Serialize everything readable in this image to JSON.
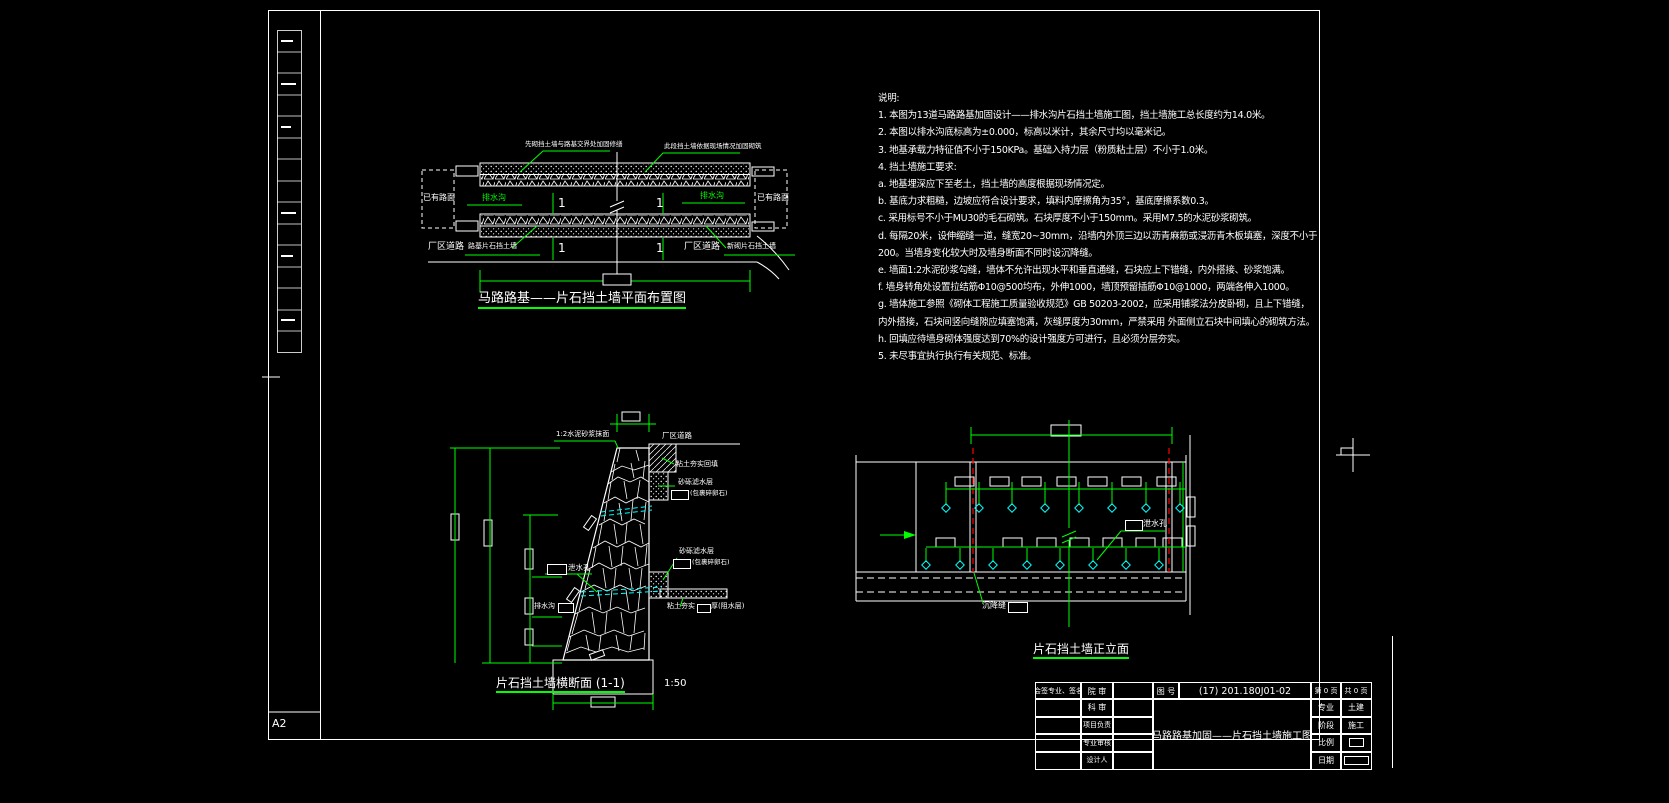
{
  "frame": {
    "size_label": "A2"
  },
  "plan": {
    "title": "马路路基——片石挡土墙平面布置图",
    "existing_left": "已有路面",
    "existing_right": "已有路面",
    "drain_left": "排水沟",
    "drain_right": "排水沟",
    "road_left": "厂区道路",
    "road_right": "厂区道路",
    "leader_top_left": "先砌挡土墙与路基交界处加固修缮",
    "leader_top_right": "此段挡土墙依据现场情况加固砌筑",
    "leader_bottom_left": "路基片石挡土墙",
    "leader_bottom_right": "新砌片石挡土墙",
    "section_mark": "1"
  },
  "notes": {
    "heading": "说明:",
    "lines": [
      "1. 本图为13道马路路基加固设计——排水沟片石挡土墙施工图，挡土墙施工总长度约为14.0米。",
      "2. 本图以排水沟底标高为±0.000，标高以米计，其余尺寸均以毫米记。",
      "3. 地基承载力特征值不小于150KPa。基础入持力层（粉质粘土层）不小于1.0米。",
      "4. 挡土墙施工要求:",
      "a. 地基埋深应下至老土，挡土墙的高度根据现场情况定。",
      "b. 基底力求粗糙，边坡应符合设计要求，填料内摩擦角为35°，基底摩擦系数0.3。",
      "c. 采用标号不小于MU30的毛石砌筑。石块厚度不小于150mm。采用M7.5的水泥砂浆砌筑。",
      "d. 每隔20米，设伸缩缝一道，缝宽20~30mm，沿墙内外顶三边以沥青麻筋或浸沥青木板填塞，深度不小于",
      "200。当墙身变化较大时及墙身断面不同时设沉降缝。",
      "e. 墙面1:2水泥砂浆勾缝，墙体不允许出现水平和垂直通缝，石块应上下错缝，内外搭接、砂浆饱满。",
      "f. 墙身转角处设置拉结筋Φ10@500均布，外伸1000，墙顶预留插筋Φ10@1000，两端各伸入1000。",
      "g. 墙体施工参照《砌体工程施工质量验收规范》GB 50203-2002，应采用铺浆法分皮卧砌，且上下错缝，",
      "内外搭接，石块间竖向缝隙应填塞饱满，灰缝厚度为30mm，严禁采用 外面侧立石块中间填心的砌筑方法。",
      "h. 回填应待墙身砌体强度达到70%的设计强度方可进行，且必须分层夯实。",
      "5. 未尽事宜执行执行有关规范、标准。"
    ]
  },
  "section": {
    "title": "片石挡土墙横断面 (1-1)",
    "scale": "1:50",
    "plaster": "1:2水泥砂浆抹面",
    "road": "厂区道路",
    "backfill": "粘土夯实回填",
    "filter_upper": "砂砾滤水层",
    "filter_upper_note": "(包裹碎卵石)",
    "filter_lower": "砂砾滤水层",
    "filter_lower_note": "(包裹碎卵石)",
    "weep": "泄水孔",
    "drain": "排水沟",
    "seal_prefix": "粘土夯实",
    "seal_suffix": "厚(阻水层)"
  },
  "elevation": {
    "title": "片石挡土墙正立面",
    "weep": "泄水孔",
    "joint": "沉降缝"
  },
  "titleblock": {
    "sign": "会签专业、签名",
    "row_labels": [
      "院 审",
      "科 审",
      "项目负责",
      "专业审核",
      "设计人"
    ],
    "no_label": "图 号",
    "no_value": "(17) 201.180J01-02",
    "title": "马路路基加固——片石挡土墙施工图",
    "page": "第 0 页",
    "pages": "共 0 页",
    "meta_labels": [
      "专业",
      "阶段",
      "比例",
      "日期"
    ],
    "meta_values": [
      "土建",
      "施工",
      "",
      ""
    ]
  },
  "colors": {
    "background": "#000000",
    "line": "#ffffff",
    "accent": "#00ff00",
    "joint": "#ff0000",
    "pipe": "#00ffff"
  }
}
